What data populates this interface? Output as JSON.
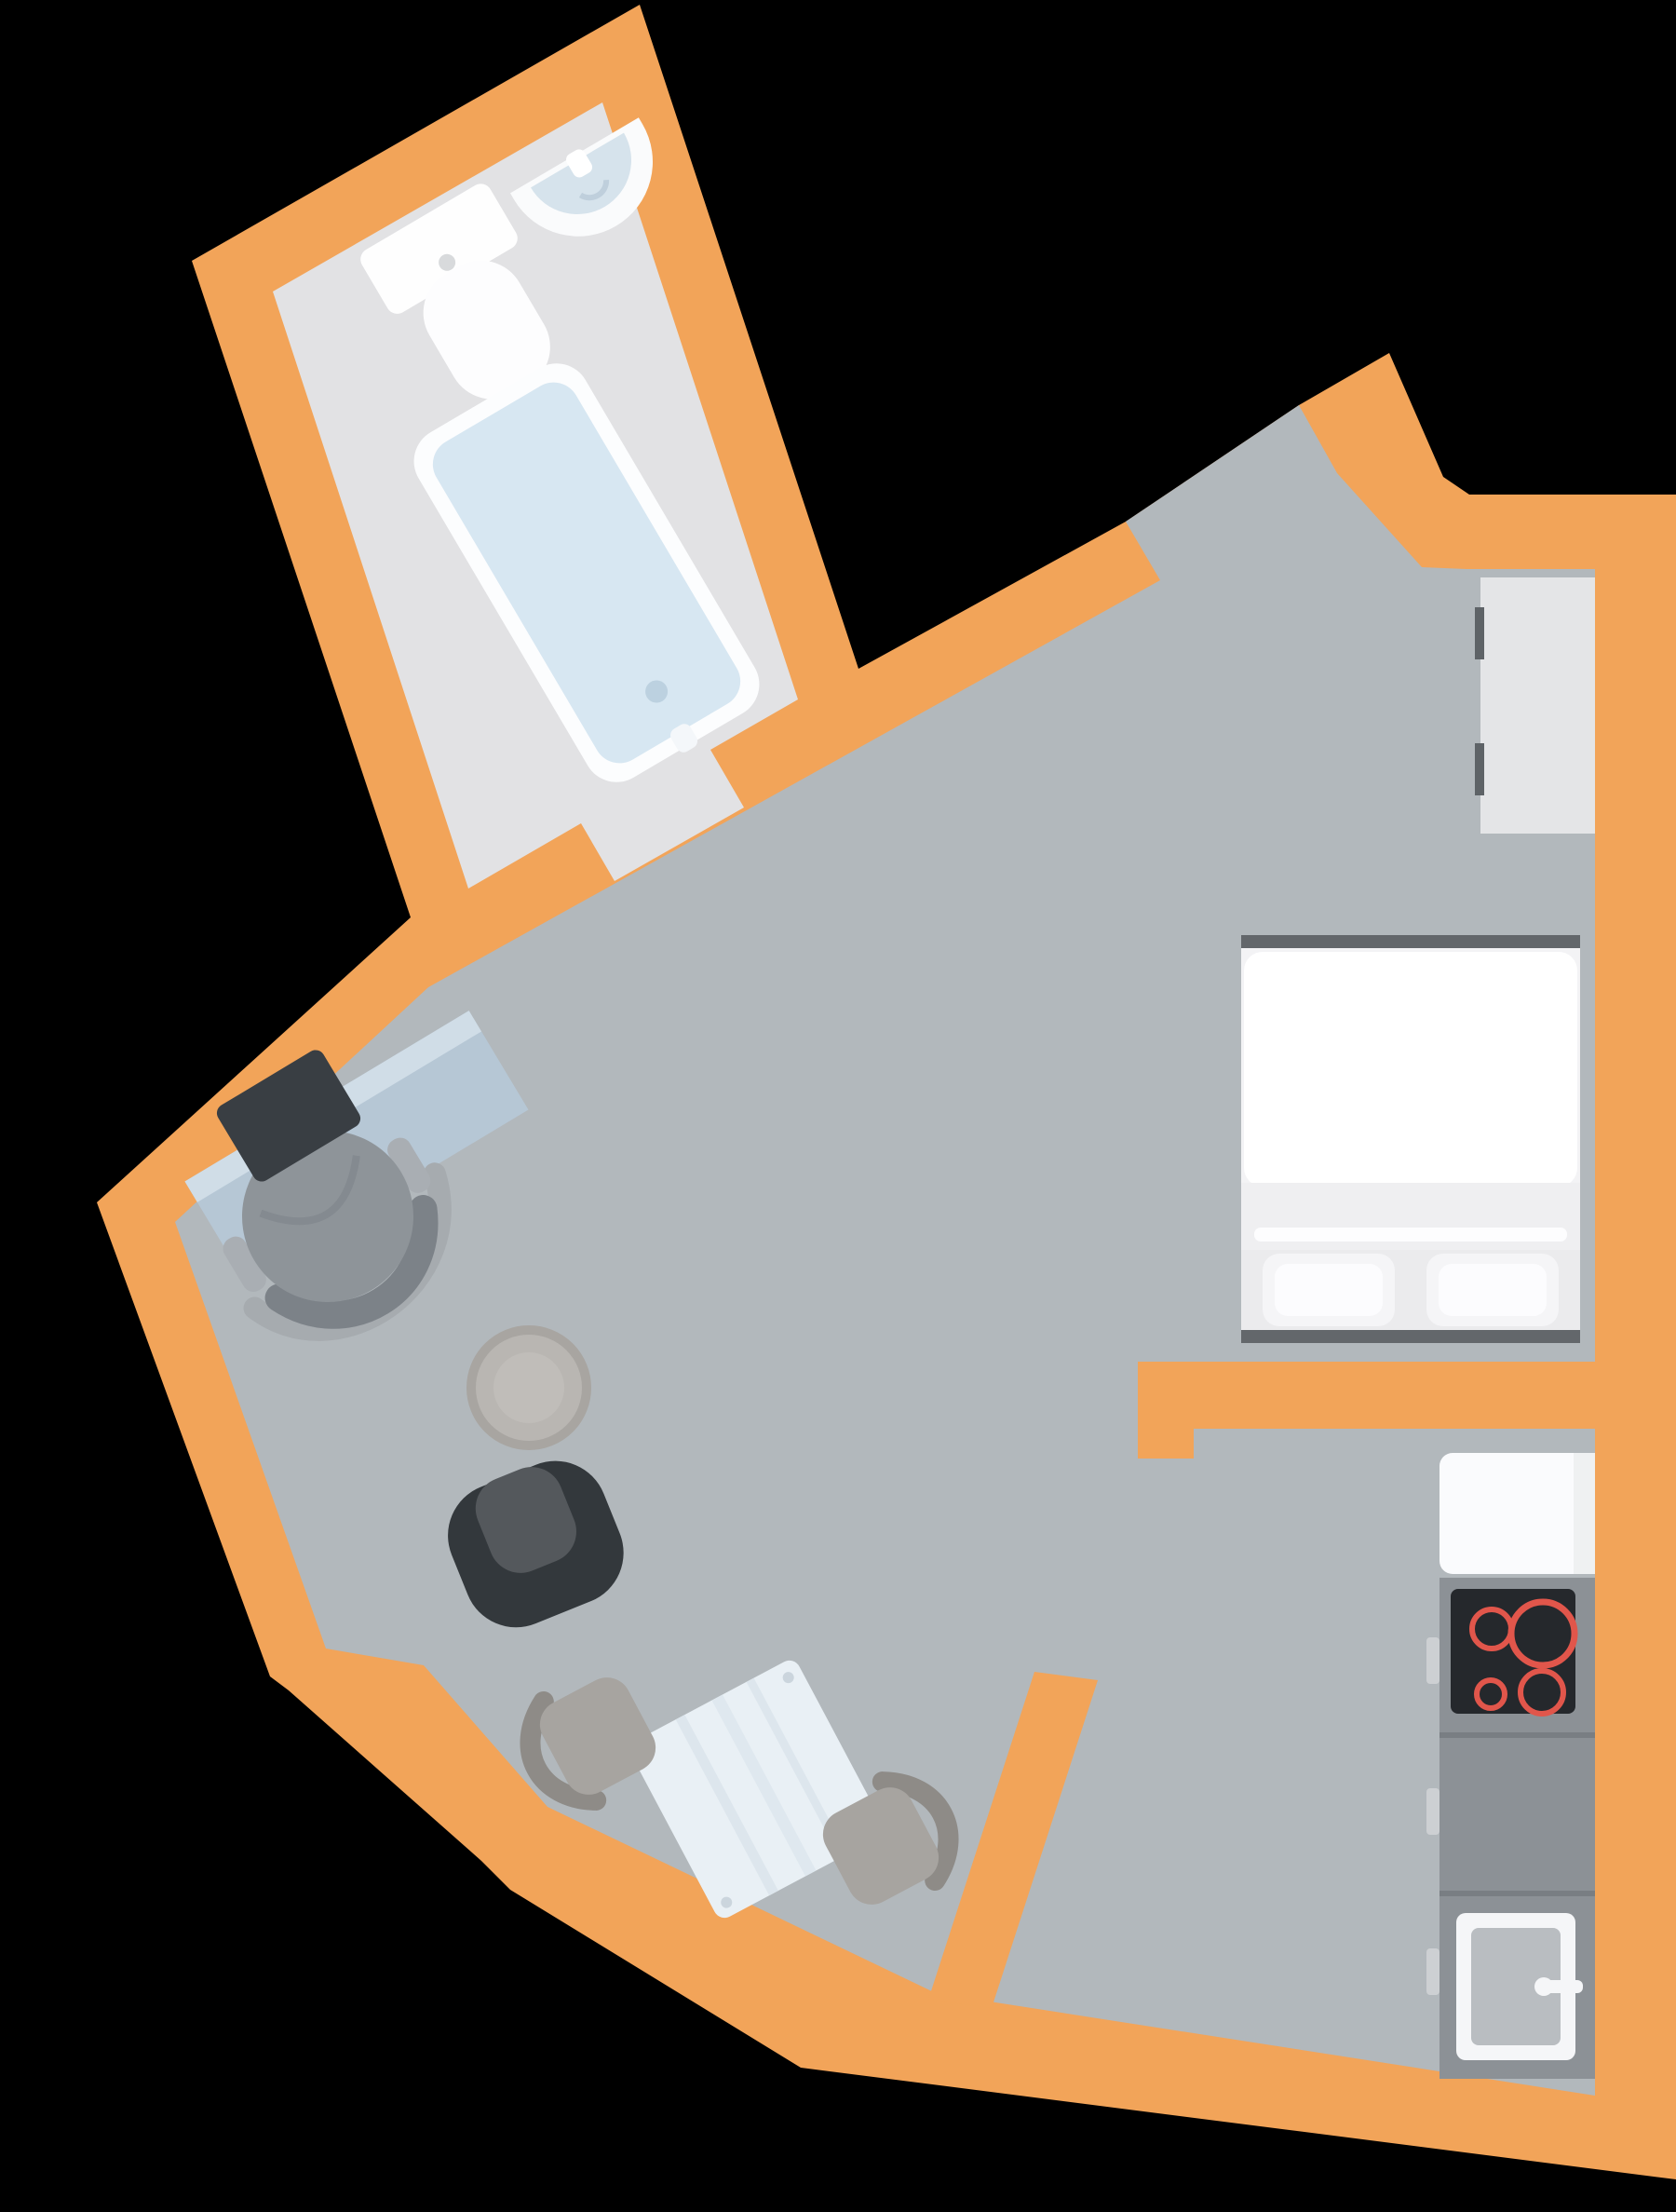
{
  "title": "studio-apartment-floor-plan",
  "colors": {
    "background": "#000000",
    "wall_orange": "#F2A459",
    "floor_main": "#B2B8BC",
    "floor_bathroom": "#E2E2E4",
    "fixture_white": "#FDFDFE",
    "water_blue": "#D7E7F2",
    "sink_blue": "#D6E3EC",
    "desk_blue": "#B6C7D5",
    "desk_edge": "#D0DDE7",
    "laptop_dark": "#393E43",
    "chair_gray": "#8E9499",
    "stool_gray": "#B9B6B2",
    "armchair_dark": "#33383C",
    "armchair_seat": "#54585C",
    "table_white": "#E9F0F5",
    "dining_chair": "#A7A4A0",
    "dining_chair_back": "#8E8B87",
    "bed_frame_dark": "#63676B",
    "duvet_white": "#FFFFFF",
    "sheet_band": "#EFEFF1",
    "pillow": "#F5F5F7",
    "wardrobe_gray": "#E4E5E7",
    "handle_dark": "#5E6367",
    "counter_gray": "#8C9196",
    "cooktop_black": "#25282C",
    "burner_red": "#E1564B",
    "basin_gray": "#B9BDC1",
    "cabinet_handle": "#CDD0D3"
  },
  "rooms": [
    {
      "name": "bathroom",
      "fixtures": [
        "toilet",
        "wash-basin",
        "bathtub"
      ]
    },
    {
      "name": "living-sleeping-area",
      "fixtures": [
        "desk",
        "laptop",
        "office-chair",
        "stool",
        "armchair",
        "dining-table",
        "dining-chair-left",
        "dining-chair-right",
        "double-bed",
        "wardrobe"
      ]
    },
    {
      "name": "kitchen",
      "fixtures": [
        "fridge-unit",
        "cooktop",
        "worktop",
        "sink-unit"
      ]
    }
  ],
  "openings": [
    "bathroom-door-gap",
    "entrance-door-gap",
    "kitchen-passage-gap"
  ]
}
